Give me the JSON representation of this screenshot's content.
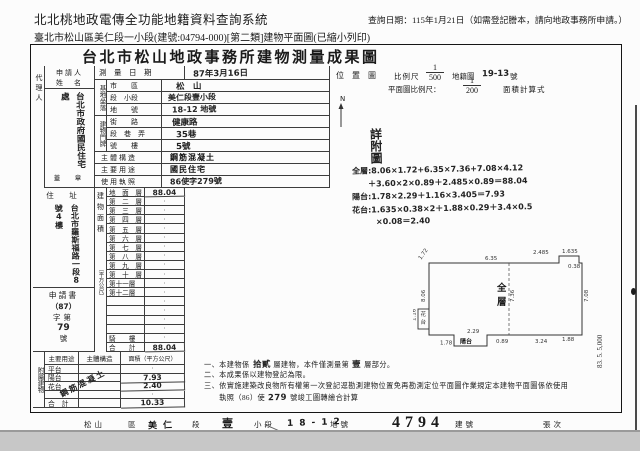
{
  "header": {
    "system_title": "北北桃地政電傳全功能地籍資料查詢系統",
    "query_date": "查詢日期：115年1月21日（如需登記謄本，請向地政事務所申請。）",
    "subtitle": "臺北市松山區美仁段一小段(建號:04794-000)[第二類]建物平面圖(已縮小列印)"
  },
  "form": {
    "title": "台北市松山地政事務所建物測量成果圖",
    "applicant": {
      "agent_label": "代理人",
      "name_label_1": "申請人",
      "name_label_2": "姓　名",
      "name": "台北市政府國民住宅處",
      "seal_label": "蓋　章",
      "address_label": "住　址",
      "address": "台北市羅斯福路一段8號4樓",
      "application_label": "申請書",
      "application_prefix": "（87）",
      "application_mid": "字第",
      "application_no": "79",
      "application_suffix": "號"
    },
    "survey": {
      "label": "測　量　日　期",
      "value": "87年3月16日"
    },
    "site": {
      "label": "基地坐落",
      "rows": [
        {
          "label": "市　　區",
          "value": "松　山"
        },
        {
          "label": "段　小段",
          "value": "美仁段壹小段"
        },
        {
          "label": "地　　號",
          "value": "18-12 地號"
        }
      ]
    },
    "door": {
      "label": "建物門牌",
      "rows": [
        {
          "label": "街　　路",
          "value": "健康路"
        },
        {
          "label": "段　巷　弄",
          "value": "35巷"
        },
        {
          "label": "號　　樓",
          "value": "5號"
        }
      ]
    },
    "structure": {
      "label": "主體構造",
      "value": "鋼筋混凝土"
    },
    "usage": {
      "label": "主要用途",
      "value": "國民住宅"
    },
    "license": {
      "label": "使用執照",
      "value": "86使字279號"
    },
    "floor_area": {
      "label": "建物面積",
      "unit": "（平方公尺）",
      "rows": [
        {
          "label": "地　面　層",
          "value": "88.04"
        },
        {
          "label": "第　二　層",
          "value": "·"
        },
        {
          "label": "第　三　層",
          "value": "·"
        },
        {
          "label": "第　四　層",
          "value": "·"
        },
        {
          "label": "第　五　層",
          "value": "·"
        },
        {
          "label": "第　六　層",
          "value": "·"
        },
        {
          "label": "第　七　層",
          "value": "·"
        },
        {
          "label": "第　八　層",
          "value": "·"
        },
        {
          "label": "第　九　層",
          "value": "·"
        },
        {
          "label": "第　十　層",
          "value": "·"
        },
        {
          "label": "第十一層",
          "value": "·"
        },
        {
          "label": "第十二層",
          "value": "·"
        },
        {
          "label": "",
          "value": "·"
        },
        {
          "label": "",
          "value": "·"
        },
        {
          "label": "",
          "value": "·"
        },
        {
          "label": "",
          "value": "·"
        },
        {
          "label": "騎　　樓",
          "value": "·"
        },
        {
          "label": "合　　計",
          "value": "88.04"
        }
      ]
    },
    "annex": {
      "label": "附屬建物",
      "headers": [
        "主要用途",
        "主體構造",
        "面積（平方公尺）"
      ],
      "structure_note": "鋼筋混凝土",
      "rows": [
        {
          "use": "平台",
          "area": "·"
        },
        {
          "use": "陽台",
          "area": "7.93"
        },
        {
          "use": "花台",
          "area": "2.40"
        },
        {
          "use": "",
          "area": "·"
        },
        {
          "use": "合　計",
          "area": "10.33"
        }
      ]
    },
    "scales": {
      "location_map_label": "位　置　圖",
      "scale_label": "比例尺",
      "location_scale_num": "1",
      "location_scale_den": "500",
      "cadastral_label": "地籍圖",
      "cadastral_no": "19-13",
      "cadastral_suffix": "號",
      "plan_scale_label": "平面圖比例尺：",
      "plan_scale_num": "1",
      "plan_scale_den": "200",
      "area_calc_label": "面積計算式",
      "north_label": "N"
    },
    "sketch_note": "詳附圖",
    "calculations": [
      "全層:8.06×1.72+6.35×7.36+7.08×4.12",
      "　　＋3.60×2×0.89＋2.485×0.89＝88.04",
      "陽台:1.78×2.29＋1.16×3.405＝7.93",
      "花台:1.635×0.38×2＋1.88×0.29＋3.4×0.5",
      "　　　×0.08＝2.40"
    ],
    "plan": {
      "room_label": "全層",
      "balcony_label": "陽台",
      "flower_label": "花台",
      "dims": [
        "1.72",
        "6.35",
        "2.485",
        "1.635",
        "8.06",
        "7.36",
        "7.08",
        "3.24",
        "1.88",
        "0.89",
        "2.29",
        "1.78",
        "1.16",
        "0.38"
      ]
    },
    "notes": [
      [
        {
          "t": "一、本建物係",
          "hw": false
        },
        {
          "t": "拾貳",
          "hw": true
        },
        {
          "t": "層建物，本件僅測量第",
          "hw": false
        },
        {
          "t": "壹",
          "hw": true
        },
        {
          "t": "層部分。",
          "hw": false
        }
      ],
      [
        {
          "t": "二、本成果係以建物登記為限。",
          "hw": false
        }
      ],
      [
        {
          "t": "三、依實施建築改良物所有權第一次登記逕勘測建物位置免再勘測定位平面圖作業規定本建物平面圖係依使用",
          "hw": false
        }
      ],
      [
        {
          "t": "　　執照（86）使",
          "hw": false
        },
        {
          "t": "279",
          "hw": true
        },
        {
          "t": "號竣工圖轉繪合計算",
          "hw": false
        }
      ]
    ],
    "footer": {
      "segments": [
        {
          "t": "松山",
          "kind": "print"
        },
        {
          "t": "區",
          "kind": "print"
        },
        {
          "t": "美仁",
          "kind": "hw"
        },
        {
          "t": "段",
          "kind": "print"
        },
        {
          "t": "壹",
          "kind": "stamp"
        },
        {
          "t": "小段",
          "kind": "print"
        },
        {
          "t": "18-12",
          "kind": "hw"
        },
        {
          "t": "地號",
          "kind": "print"
        },
        {
          "t": "4794",
          "kind": "big"
        },
        {
          "t": "建號",
          "kind": "print"
        },
        {
          "t": "張次",
          "kind": "print"
        }
      ]
    },
    "print_mark": "83. 5. 5,000"
  }
}
